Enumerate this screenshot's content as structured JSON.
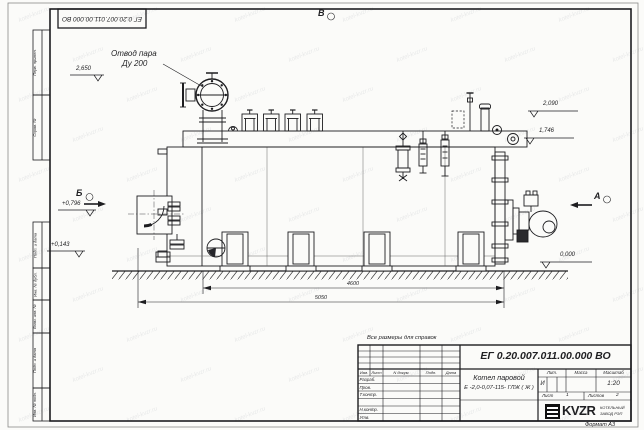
{
  "sheet": {
    "stamp_number": "ЕГ 0.20.007.011.00.000  ВО",
    "format_label": "Формат А3",
    "watermark": "kotel-kvzr.ru",
    "margin_labels": [
      "Перв. примен.",
      "Справ. №",
      "Подп. и дата",
      "Инв. № дубл.",
      "Взам. инв. №",
      "Подп. и дата",
      "Инв. № подл."
    ]
  },
  "annotations": {
    "callout": {
      "line1": "Отвод пара",
      "line2": "Ду 200"
    },
    "views": {
      "a": "А",
      "b": "Б",
      "v": "В"
    },
    "levels": {
      "steam": "2,650",
      "front_upper": "+0,796",
      "front_lower": "+0,143",
      "rear_top": "2,090",
      "rear_mid": "1,746",
      "ground": "0,000"
    },
    "dimensions": {
      "body_length": "4600",
      "total_length": "5050"
    },
    "reference_note": "Все размеры для справок"
  },
  "title_block": {
    "doc_number": "ЕГ 0.20.007.011.00.000  ВО",
    "product_name": "Котел паровой",
    "product_code": "Е -2,0-0,07-115- ГЛЖ ( Ж )",
    "columns": {
      "izm": "Изм.",
      "list": "Лист",
      "doc": "N докум.",
      "sign": "Подп.",
      "date": "Дата"
    },
    "roles": [
      "Разраб.",
      "Пров.",
      "Т.контр.",
      "Н.контр.",
      "Утв."
    ],
    "lit_label": "Лит.",
    "lit_value": "И",
    "mass_label": "Масса",
    "scale_label": "Масштаб",
    "scale_value": "1:20",
    "sheet_label": "Лист",
    "sheet_value": "1",
    "sheets_label": "Листов",
    "sheets_value": "2",
    "org_logo": "KVZR",
    "org_name_line1": "КОТЕЛЬНЫЙ",
    "org_name_line2": "ЗАВОД РЭП"
  }
}
